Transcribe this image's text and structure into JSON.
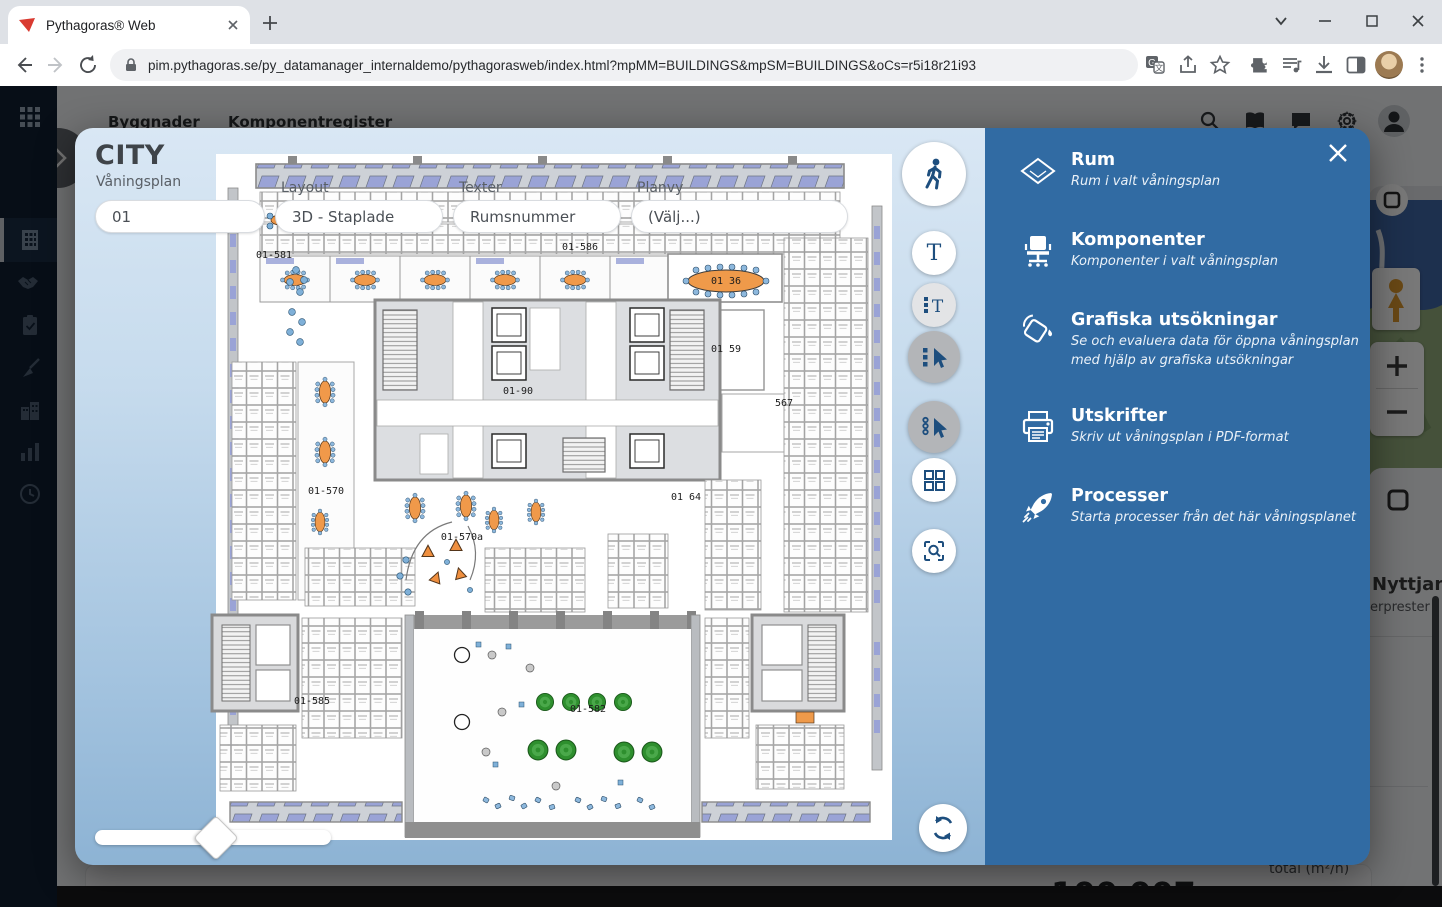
{
  "browser": {
    "tab_title": "Pythagoras® Web",
    "url": "pim.pythagoras.se/py_datamanager_internaldemo/pythagorasweb/index.html?mpMM=BUILDINGS&mpSM=BUILDINGS&oCs=r5i18r21i93"
  },
  "app": {
    "tabs": [
      {
        "label": "Byggnader"
      },
      {
        "label": "Komponentregister"
      }
    ]
  },
  "modal": {
    "title": "CITY",
    "fields": [
      {
        "label": "Våningsplan",
        "value": "01"
      },
      {
        "label": "Layout",
        "value": "3D - Staplade"
      },
      {
        "label": "Texter",
        "value": "Rumsnummer"
      },
      {
        "label": "Planvy",
        "value": "(Välj...)"
      }
    ],
    "panel": {
      "items": [
        {
          "title": "Rum",
          "subtitle": "Rum i valt våningsplan",
          "icon": "room-diamond-icon"
        },
        {
          "title": "Komponenter",
          "subtitle": "Komponenter i valt våningsplan",
          "icon": "office-chair-icon"
        },
        {
          "title": "Grafiska utsökningar",
          "subtitle": "Se och evaluera data för öppna våningsplan med hjälp av grafiska utsökningar",
          "icon": "paint-bucket-icon"
        },
        {
          "title": "Utskrifter",
          "subtitle": "Skriv ut våningsplan i PDF-format",
          "icon": "printer-icon"
        },
        {
          "title": "Processer",
          "subtitle": "Starta processer från det här våningsplanet",
          "icon": "rocket-icon"
        }
      ]
    },
    "floorplan": {
      "labels": [
        {
          "text": "01-586",
          "x": 380,
          "y": 100
        },
        {
          "text": "01-581",
          "x": 74,
          "y": 108
        },
        {
          "text": "01 36",
          "x": 526,
          "y": 134
        },
        {
          "text": "01 59",
          "x": 526,
          "y": 202
        },
        {
          "text": "01-90",
          "x": 318,
          "y": 244
        },
        {
          "text": "567",
          "x": 584,
          "y": 256
        },
        {
          "text": "01 64",
          "x": 486,
          "y": 350
        },
        {
          "text": "01-570",
          "x": 126,
          "y": 344
        },
        {
          "text": "01-570a",
          "x": 262,
          "y": 390
        },
        {
          "text": "01-585",
          "x": 112,
          "y": 554
        },
        {
          "text": "01-582",
          "x": 388,
          "y": 562
        }
      ]
    }
  },
  "background": {
    "map": {
      "terms_label": "darvillkor"
    },
    "usage_card": {
      "line1": "Nyttjan",
      "line2": "erprester"
    },
    "total_card": {
      "value": "100 007",
      "unit_label": "total (m²/h)"
    }
  },
  "icons": {
    "toolbar": [
      "walk-icon",
      "text-icon",
      "multi-text-icon",
      "multi-select-cursor-icon",
      "lasso-cursor-icon",
      "tiles-icon",
      "scan-search-icon",
      "rotate-sync-icon"
    ],
    "sidebar": [
      "apps-grid-icon",
      "building-icon",
      "handshake-icon",
      "clipboard-icon",
      "broom-icon",
      "city-icon",
      "bar-chart-icon",
      "clock-icon"
    ],
    "header": [
      "search-icon",
      "book-icon",
      "chat-icon",
      "gear-icon",
      "user-icon"
    ]
  }
}
